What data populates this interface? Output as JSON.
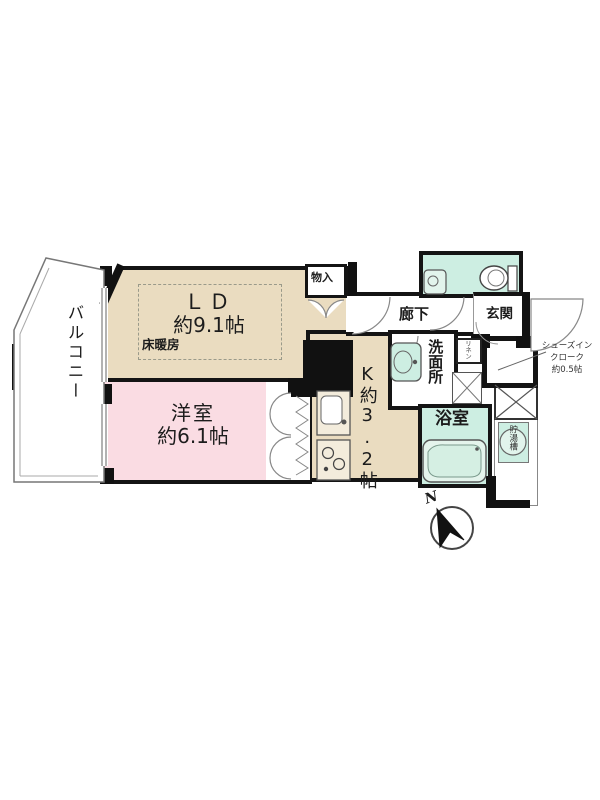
{
  "plan_title": "1LDK apartment floor plan",
  "rooms": {
    "balcony": {
      "label": "バルコニー"
    },
    "ld": {
      "label": "ＬＤ",
      "size": "約9.1帖",
      "floor_heating": "床暖房"
    },
    "western_room": {
      "label": "洋室",
      "size": "約6.1帖"
    },
    "kitchen": {
      "label": "K約3.2帖"
    },
    "storage": {
      "label": "物入"
    },
    "hallway": {
      "label": "廊下"
    },
    "entrance": {
      "label": "玄関"
    },
    "washroom": {
      "label": "洗面所"
    },
    "bathroom": {
      "label": "浴室"
    },
    "linen": {
      "label": "リネン"
    },
    "shoe_closet": {
      "lines": [
        "シューズイン",
        "クローク",
        "約0.5帖"
      ]
    },
    "water_tank": {
      "label": "貯湯槽"
    }
  },
  "compass": {
    "label": "N"
  },
  "colors": {
    "wall": "#141414",
    "ld_fill": "#eadcc0",
    "western_room_fill": "#fadce3",
    "wet_area_fill": "#cdeee2",
    "dashed_zone": "#9a9a8a"
  }
}
